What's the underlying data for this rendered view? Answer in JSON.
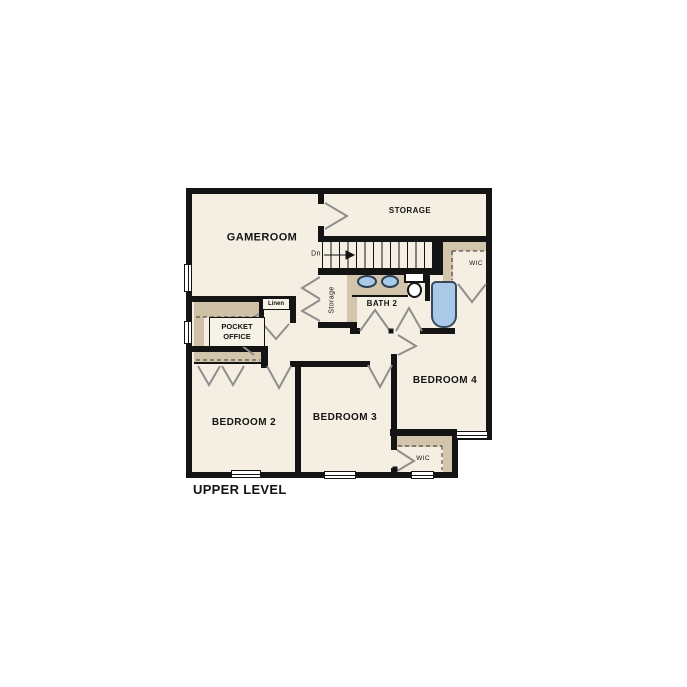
{
  "title": "UPPER LEVEL",
  "rooms": {
    "gameroom": "GAMEROOM",
    "storage_room": "STORAGE",
    "bath": "BATH 2",
    "storage_closet": "Storage",
    "stair_direction": "Dn",
    "wic_upper": "WIC",
    "wic_lower": "WIC",
    "linen": "Linen",
    "pocket_office": "POCKET OFFICE",
    "bedroom2": "BEDROOM 2",
    "bedroom3": "BEDROOM 3",
    "bedroom4": "BEDROOM 4"
  },
  "colors": {
    "wall": "#141414",
    "floor": "#f5efe3",
    "shelving": "#d2c5ab",
    "fixture_blue": "#a9c9e8",
    "door_swing": "#8e8e8e"
  }
}
